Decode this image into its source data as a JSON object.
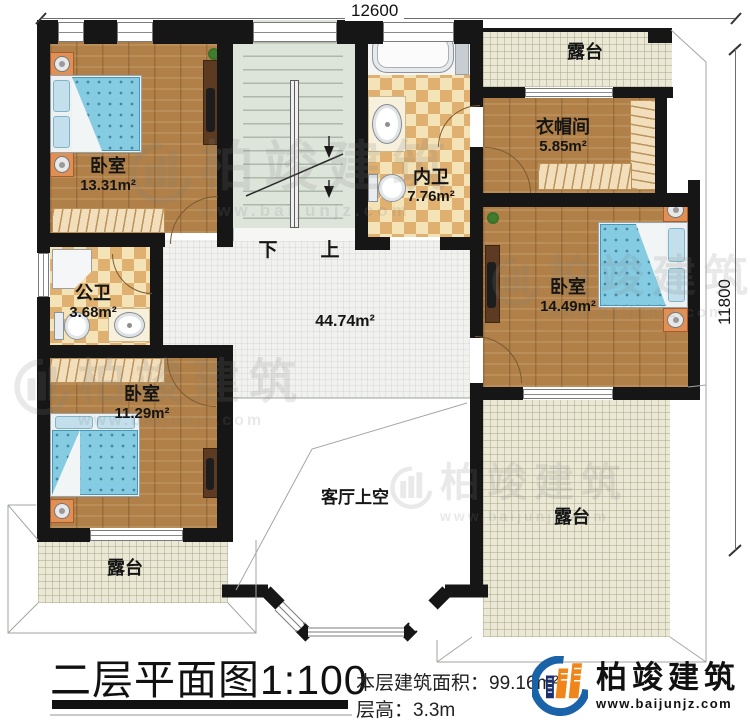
{
  "dims": {
    "top": "12600",
    "right": "11800"
  },
  "rooms": {
    "bedroom_top_left": {
      "label": "卧室",
      "area": "13.31m²"
    },
    "bedroom_right": {
      "label": "卧室",
      "area": "14.49m²"
    },
    "bedroom_bottom_left": {
      "label": "卧室",
      "area": "11.29m²"
    },
    "cloakroom": {
      "label": "衣帽间",
      "area": "5.85m²"
    },
    "bath_inner": {
      "label": "内卫",
      "area": "7.76m²"
    },
    "bath_public": {
      "label": "公卫",
      "area": "3.68m²"
    },
    "hall": {
      "area": "44.74m²"
    },
    "terrace_top": {
      "label": "露台"
    },
    "terrace_bottom_left": {
      "label": "露台"
    },
    "terrace_bottom_right": {
      "label": "露台"
    },
    "living_room_void": {
      "label": "客厅上空"
    }
  },
  "stairs": {
    "down": "下",
    "up": "上"
  },
  "footer": {
    "title": "二层平面图1:100",
    "area_label": "本层建筑面积：",
    "area_value": "99.16m²",
    "height_label": "层高：",
    "height_value": "3.3m"
  },
  "branding": {
    "name": "柏竣建筑",
    "website": "www.baijunjz.com"
  },
  "watermark": {
    "name": "柏竣建筑",
    "website": "www.baijunjz.com"
  },
  "colors": {
    "wall": "#161616",
    "wood": "#b08048",
    "bath_tile": "#dfb06f",
    "terrace_tile": "#ebe9d6",
    "stair": "#dde4da",
    "bed": "#85cbe2",
    "logo_blue": "#1b63a8",
    "logo_orange": "#f08519"
  }
}
